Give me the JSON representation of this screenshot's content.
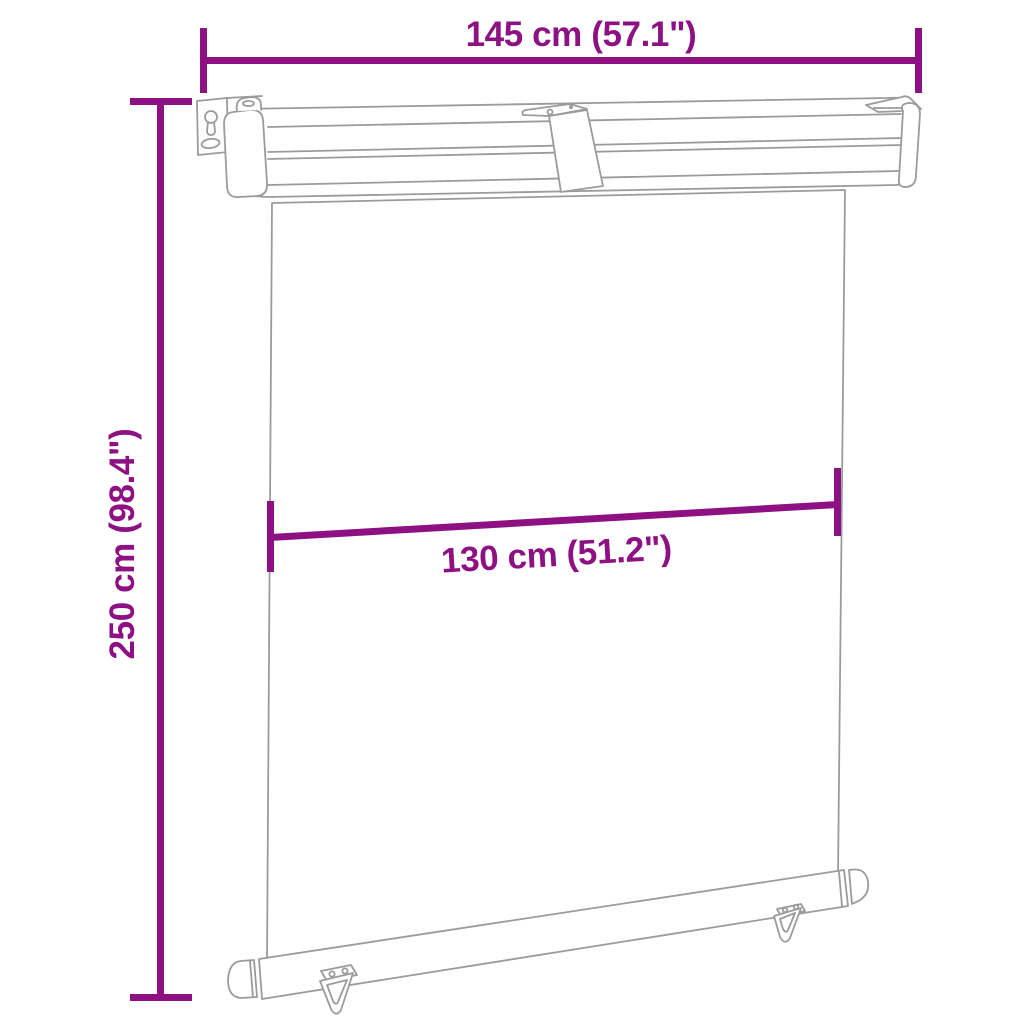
{
  "diagram": {
    "annotations": {
      "width": "145 cm (57.1\")",
      "height": "250 cm (98.4\")",
      "fabric_width": "130 cm (51.2\")"
    },
    "colors": {
      "dimension_accent": "#8d1183",
      "line_art": "#9b9b9b",
      "background": "#ffffff"
    }
  }
}
